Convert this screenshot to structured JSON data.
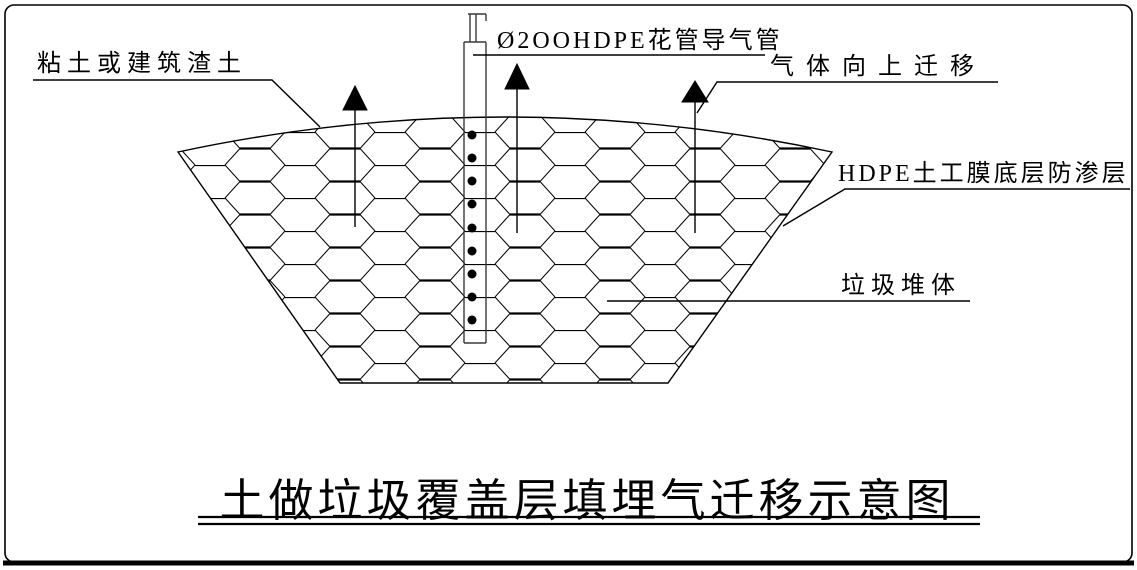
{
  "diagram": {
    "title": "土做垃圾覆盖层填埋气迁移示意图",
    "labels": {
      "cover_soil": "粘土或建筑渣土",
      "gas_pipe": "Ø2OOHDPE花管导气管",
      "gas_migration": "气体向上迁移",
      "hdpe_liner": "HDPE土工膜底层防渗层",
      "waste_body": "垃圾堆体"
    },
    "colors": {
      "line": "#000000",
      "background": "#ffffff"
    },
    "pipe": {
      "perforation_count": 9
    }
  }
}
